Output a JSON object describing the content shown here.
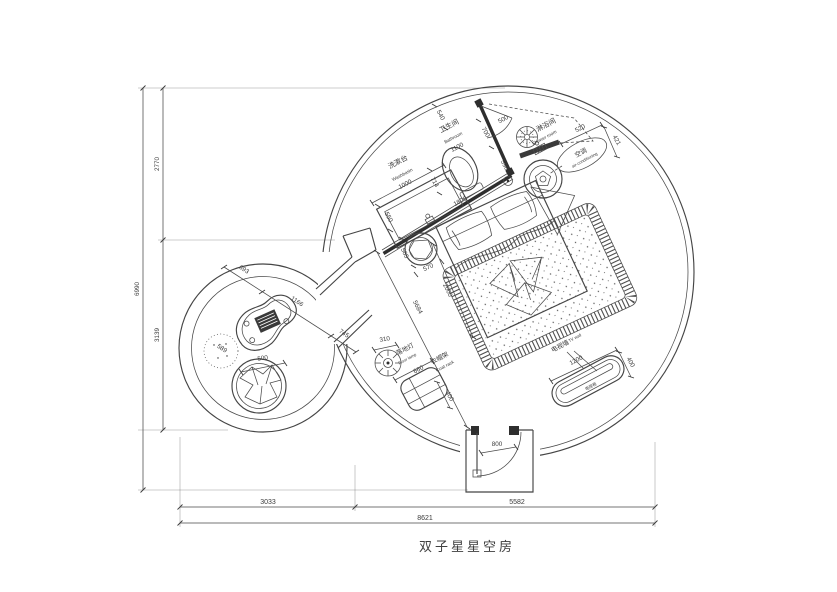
{
  "title": "双子星星空房",
  "labels": {
    "washbasin_cn": "洗漱台",
    "washbasin_en": "Washbasin",
    "bathroom_cn": "卫生间",
    "bathroom_en": "Bathroom",
    "shower_cn": "淋浴间",
    "shower_en": "Shower room",
    "ac_cn": "空调",
    "ac_en": "air-conditioning",
    "lamp_cn": "落地灯",
    "lamp_en": "Floor lamp",
    "rack_cn": "衣帽架",
    "rack_en": "Coat rack",
    "tv_cn": "电视墙",
    "tv_en": "TV wall",
    "tv_cabinet": "电视柜"
  },
  "dims": {
    "washbasin": "1000",
    "basin_depth": "550",
    "bathroom": "1100",
    "d540": "540",
    "d700": "700",
    "door": "500",
    "d590": "590",
    "d714": "714",
    "wall": "1800",
    "d520": "520",
    "d421": "421",
    "d565": "565",
    "d570": "570",
    "bed": "2000",
    "diag": "5684",
    "lamp": "310",
    "rack_w": "660",
    "rack_d": "400",
    "tv_w": "1200",
    "tv_d": "400",
    "entry": "800",
    "c693": "693",
    "c1166": "1166",
    "c745": "745",
    "c589": "589",
    "chair": "500",
    "v2770": "2770",
    "v3139": "3139",
    "v6990": "6990",
    "h3033": "3033",
    "h5582": "5582",
    "h8621": "8621"
  },
  "colors": {
    "line": "#4a4a4a",
    "wall": "#2e2e2e",
    "text": "#3a3a3a",
    "bg": "#ffffff"
  }
}
